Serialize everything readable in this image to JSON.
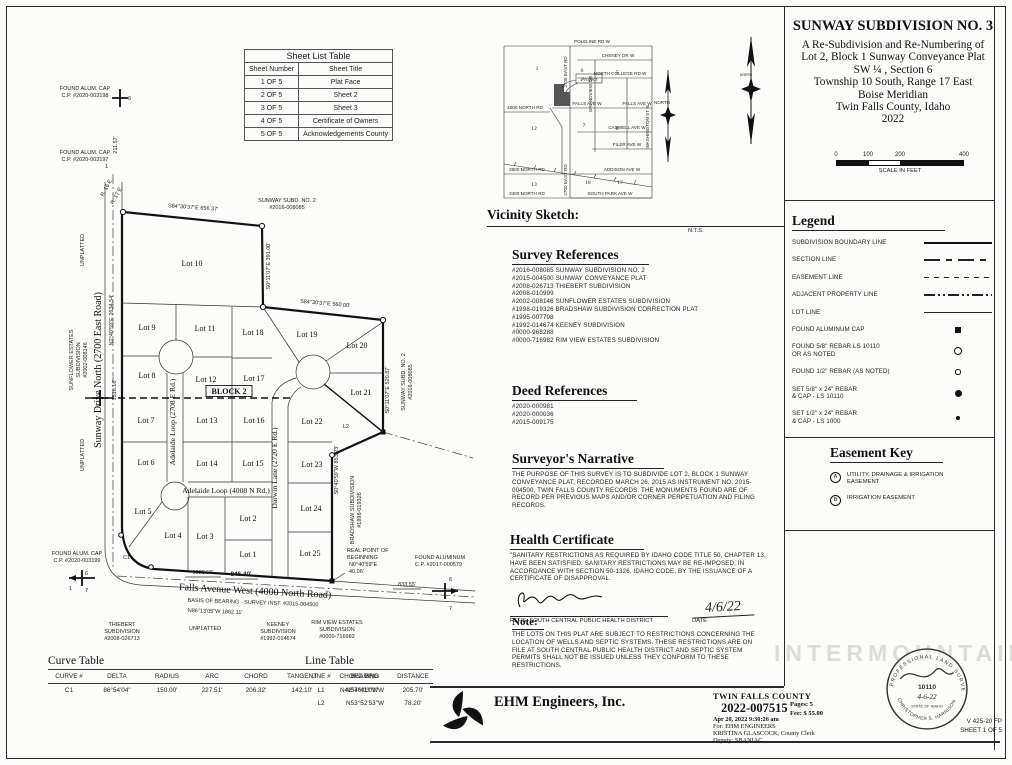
{
  "sheet_table": {
    "title": "Sheet List Table",
    "headers": [
      "Sheet Number",
      "Sheet Title"
    ],
    "rows": [
      [
        "1 OF 5",
        "Plat Face"
      ],
      [
        "2 OF 5",
        "Sheet 2"
      ],
      [
        "3 OF 5",
        "Sheet 3"
      ],
      [
        "4 OF 5",
        "Certificate of Owners"
      ],
      [
        "5 OF 5",
        "Acknowledgements County"
      ]
    ]
  },
  "title_block": {
    "lines": [
      "SUNWAY SUBDIVISION NO. 3",
      "A Re-Subdivision and Re-Numbering of",
      "Lot 2, Block 1 Sunway Conveyance Plat",
      "SW ¼ , Section 6",
      "Township 10 South, Range 17 East",
      "Boise Meridian",
      "Twin Falls County, Idaho",
      "2022"
    ],
    "scale_ticks": [
      "0",
      "100",
      "200",
      "400"
    ],
    "scale_caption": "SCALE IN FEET"
  },
  "vicinity": {
    "heading": "Vicinity Sketch:",
    "scale_note": "N.T.S.",
    "project": "Project",
    "north": "NORTH",
    "streets": {
      "poleline": "POLELINE RD W",
      "cheney": "CHENEY DR W",
      "college": "NORTH COLLEGE RD W",
      "falls": "FALLS AVE W",
      "falls2": "FALLS AVE W",
      "caswell": "CASWELL AVE W",
      "filer": "FILER AVE W",
      "addison": "ADDISON AVE W",
      "southpark": "SOUTH PARK AVE W",
      "n4000": "4000 NORTH RD",
      "n3600": "3600 NORTH RD",
      "n3400": "3400 NORTH RD",
      "e2700a": "2700 EAST RD",
      "e2700b": "2700 EAST RD",
      "grandview": "GRANDVIEW DR",
      "washington": "WASHINGTON ST N"
    },
    "sections": [
      "1",
      "6",
      "5",
      "12",
      "7",
      "8",
      "13",
      "18",
      "17"
    ]
  },
  "survey_refs": {
    "heading": "Survey References",
    "items": [
      "#2016-008085  SUNWAY SUBDIVISION NO. 2",
      "#2015-004500  SUNWAY CONVEYANCE PLAT",
      "#2008-026713  THIEBERT SUBDIVISION",
      "#2008-010999",
      "#2002-008146  SUNFLOWER ESTATES SUBDIVISION",
      "#1998-019326  BRADSHAW SUBDIVISION CORRECTION PLAT",
      "#1995-007798",
      "#1992-014674  KEENEY SUBDIVISION",
      "#0000-968288",
      "#0000-716982  RIM VIEW ESTATES SUBDIVISION"
    ]
  },
  "deed_refs": {
    "heading": "Deed References",
    "items": [
      "#2020-000981",
      "#2020-000036",
      "#2015-009175"
    ]
  },
  "narrative": {
    "heading": "Surveyor's Narrative",
    "body": "THE PURPOSE OF THIS SURVEY IS TO SUBDIVIDE LOT 2, BLOCK 1 SUNWAY CONVEYANCE PLAT, RECORDED MARCH 26, 2015 AS INSTRUMENT NO. 2015-004500, TWIN FALLS COUNTY RECORDS. THE MONUMENTS FOUND ARE OF RECORD PER PREVIOUS MAPS AND/OR CORNER PERPETUATION AND FILING RECORDS."
  },
  "health": {
    "heading": "Health Certificate",
    "body": "\"SANITARY RESTRICTIONS AS REQUIRED BY IDAHO CODE TITLE 50, CHAPTER 13, HAVE BEEN SATISFIED. SANITARY RESTRICTIONS MAY BE RE-IMPOSED, IN ACCORDANCE WITH SECTION 50-1326, IDAHO CODE, BY THE ISSUANCE OF A CERTIFICATE OF DISAPPROVAL.",
    "signer": "REHS, SOUTH CENTRAL PUBLIC HEALTH DISTRICT",
    "date_label": "DATE",
    "date": "4/6/22"
  },
  "note": {
    "heading": "Note:",
    "body": "THE LOTS ON THIS PLAT ARE SUBJECT TO RESTRICTIONS CONCERNING THE LOCATION OF WELLS AND SEPTIC SYSTEMS.  THESE RESTRICTIONS ARE ON FILE AT SOUTH CENTRAL PUBLIC HEALTH DISTRICT AND SEPTIC SYSTEM PERMITS SHALL NOT BE ISSUED UNLESS THEY CONFORM TO THESE RESTRICTIONS."
  },
  "legend": {
    "heading": "Legend",
    "items": [
      {
        "l1": "SUBDIVISION BOUNDARY LINE",
        "l2": ""
      },
      {
        "l1": "SECTION LINE",
        "l2": ""
      },
      {
        "l1": "EASEMENT LINE",
        "l2": ""
      },
      {
        "l1": "ADJACENT PROPERTY LINE",
        "l2": ""
      },
      {
        "l1": "LOT LINE",
        "l2": ""
      },
      {
        "l1": "FOUND ALUMINUM CAP",
        "l2": ""
      },
      {
        "l1": "FOUND 5/8\" REBAR LS 10110",
        "l2": "OR AS NOTED"
      },
      {
        "l1": "FOUND 1/2\" REBAR (AS NOTED)",
        "l2": ""
      },
      {
        "l1": "SET 5/8\" x 24\" REBAR",
        "l2": "& CAP - LS 10110"
      },
      {
        "l1": "SET 1/2\" x 24\" REBAR",
        "l2": "& CAP - LS 1000"
      }
    ]
  },
  "easement_key": {
    "heading": "Easement Key",
    "items": [
      {
        "key": "A",
        "l1": "UTILITY, DRAINAGE & IRRIGATION",
        "l2": "EASEMENT"
      },
      {
        "key": "B",
        "l1": "IRRIGATION EASEMENT",
        "l2": ""
      }
    ]
  },
  "curve_table": {
    "heading": "Curve Table",
    "headers": [
      "CURVE #",
      "DELTA",
      "RADIUS",
      "ARC",
      "CHORD",
      "TANGENT",
      "CHORD BRG"
    ],
    "rows": [
      [
        "C1",
        "86°54'04\"",
        "150.00'",
        "227.51'",
        "206.32'",
        "142.10'",
        "N42°46'03\"W"
      ]
    ]
  },
  "line_table": {
    "heading": "Line Table",
    "headers": [
      "LINE #",
      "BEARING",
      "DISTANCE"
    ],
    "rows": [
      [
        "L1",
        "N57°41'01\"W",
        "205.70'"
      ],
      [
        "L2",
        "N53°52'53\"W",
        "78.20'"
      ]
    ]
  },
  "firm": {
    "name": "EHM Engineers, Inc."
  },
  "recording": {
    "county": "TWIN FALLS COUNTY",
    "instrument": "2022-007515",
    "datetime": "Apr 20, 2022    9:30:26 am",
    "pages": "Pages:   5",
    "fee": "Fee: $ 55.00",
    "for_line": "For: EHM ENGINEERS",
    "clerk": "KRISTINA GLASCOCK, County Clerk",
    "deputy": "Deputy: SBANIAC"
  },
  "stamp": {
    "arc_top": "PROFESSIONAL LAND SURVEYOR",
    "number": "10110",
    "date": "4-6-22",
    "state": "STATE OF IDAHO",
    "name": "CHRISTOPHER S. HARRISON"
  },
  "sheet_info": {
    "code": "V 425-20 FP",
    "sheet": "SHEET 1 OF 5"
  },
  "watermark": "INTERMOUNTAIN",
  "north_label": "NORTH",
  "map": {
    "lots": [
      "Lot 10",
      "Lot 9",
      "Lot 11",
      "Lot 18",
      "Lot 19",
      "Lot 20",
      "Lot 8",
      "Lot 12",
      "Lot 17",
      "Lot 21",
      "Lot 7",
      "Lot 13",
      "Lot 16",
      "Lot 22",
      "Lot 6",
      "Lot 14",
      "Lot 15",
      "Lot 23",
      "Lot 5",
      "Lot 4",
      "Lot 3",
      "Lot 2",
      "Lot 24",
      "Lot 1",
      "Lot 25"
    ],
    "block": "BLOCK 2",
    "roads": {
      "sunway": "Sunway Drive North (2700 East Road)",
      "adelaide_v": "Adelaide Loop (2708 E Rd.)",
      "adelaide_h": "Adelaide Loop (4008 N Rd.)",
      "darwin": "Darwin Lane (2720 E Rd.)",
      "falls": "Falls Avenue West (4000 North Road)"
    },
    "b": {
      "top": "S84°30'37\"E  656.37'",
      "lot10e": "S0°11'07\"E  391.00'",
      "mid": "S84°30'37\"E  560.00'",
      "east": "S0°11'07\"E  520.87'",
      "se": "S0°40'59\"W  853.23'",
      "west": "N2°40'59\"E  2634.54'",
      "basis1": "BASIS OF BEARING - SURVEY INST. #2015-004500",
      "basis2": "N86°13'05\"W  1862.11'"
    },
    "d": {
      "d1518": "1518.16'",
      "d211": "211.57'",
      "d1028": "1028.56'",
      "d846": "846.40'",
      "d833": "833.55'"
    },
    "lb": {
      "sunway2_1": "SUNWAY SUBD. NO. 2",
      "sunway2_2": "#2016-008085",
      "bradshaw_1": "BRADSHAW SUBDIVISION",
      "bradshaw_2": "#1998-019326",
      "unplatted": "UNPLATTED",
      "sunflower_1": "SUNFLOWER ESTATES",
      "sunflower_2": "SUBDIVISION",
      "sunflower_3": "#2002-008146",
      "cap198_1": "FOUND ALUM. CAP",
      "cap198_2": "C.P. #2020-003198",
      "cap197_1": "FOUND ALUM. CAP",
      "cap197_2": "C.P. #2020-003197",
      "cap199_1": "FOUND ALUM. CAP",
      "cap199_2": "C.P. #2020-003199",
      "cap579_1": "FOUND ALUMINUM",
      "cap579_2": "C.P. #2017-000579",
      "rpb_1": "REAL POINT OF",
      "rpb_2": "BEGINNING",
      "rpb_3": "N0°40'59\"E",
      "rpb_4": "40.06'",
      "thiebert_1": "THIEBERT",
      "thiebert_2": "SUBDIVISION",
      "thiebert_3": "#2008-026713",
      "keeney_1": "KEENEY",
      "keeney_2": "SUBDIVISION",
      "keeney_3": "#1992-014674",
      "rimview_1": "RIM VIEW ESTATES",
      "rimview_2": "SUBDIVISION",
      "rimview_3": "#0000-716982",
      "r16": "R. 16 E.",
      "r17": "R. 17 E.",
      "l2": "L2",
      "c1": "C1",
      "s1": "1",
      "s6": "6",
      "s7": "7"
    }
  }
}
